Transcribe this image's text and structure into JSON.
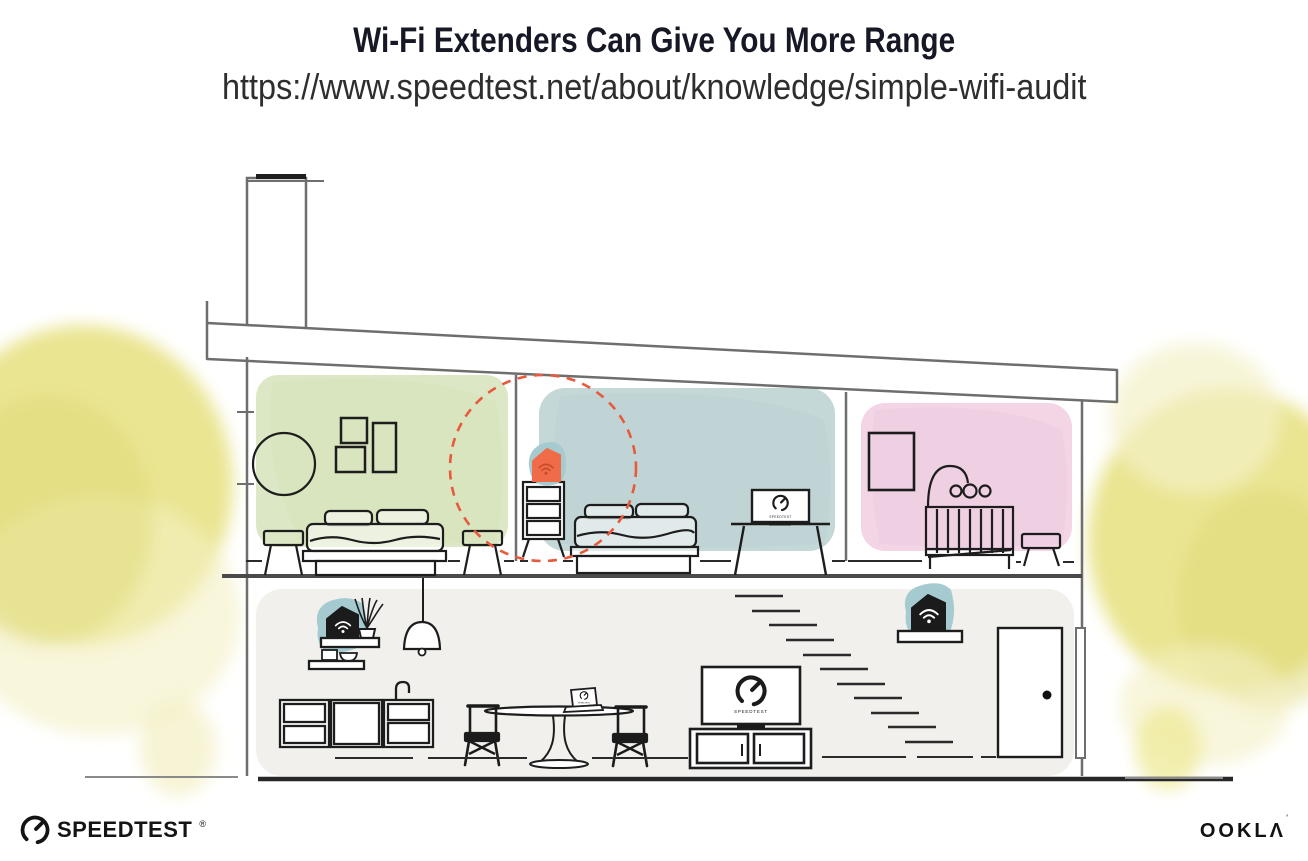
{
  "header": {
    "title": "Wi-Fi Extenders Can Give You More Range",
    "url": "https://www.speedtest.net/about/knowledge/simple-wifi-audit"
  },
  "branding": {
    "speedtest_wordmark": "SPEEDTEST",
    "speedtest_reg_mark": "®",
    "ookla_wordmark": "OOKLΛ",
    "ookla_trade_mark": "’"
  },
  "illustration": {
    "screens": {
      "upstairs_tv_label": "SPEEDTEST",
      "downstairs_tv_label": "SPEEDTEST",
      "laptop_label": "SPEEDTEST"
    },
    "icons": [
      "wifi-icon",
      "speedtest-gauge-icon"
    ],
    "colors": {
      "extender_highlight_orange": "#f06c48",
      "extender_wifi_dark_orange": "#c64a28",
      "device_black": "#1b1b1b",
      "device_backdrop_teal": "#a5cbd1",
      "coverage_circle_red": "#e65a3e",
      "bedroom_green": "#dce8c5",
      "bedroom_blue": "#c5d8d8",
      "nursery_pink": "#f3d5e6",
      "ground_floor_gray": "#f1f0ed",
      "foliage_yellow": "#e8e388"
    }
  }
}
